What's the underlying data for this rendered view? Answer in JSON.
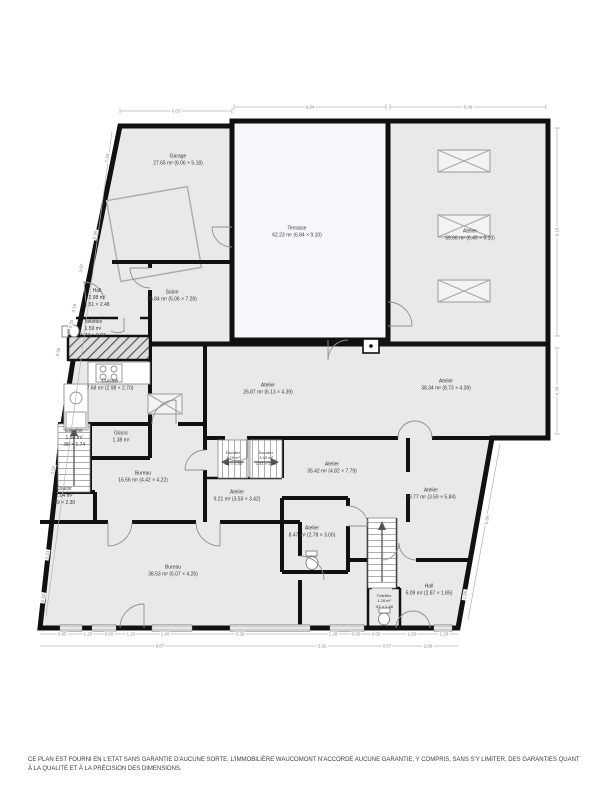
{
  "disclaimer": "CE PLAN EST FOURNI EN L'ETAT SANS GARANTIE D'AUCUNE SORTE. L'IMMOBILIÈRE WAUCOMONT N'ACCORDE AUCUNE GARANTIE, Y COMPRIS, SANS S'Y LIMITER, DES GARANTIES QUANT À LA QUALITÉ ET À LA PRÉCISION DES DIMENSIONS.",
  "rooms": {
    "garage": {
      "name": "Garage",
      "area": "27.65 m²",
      "dims": "(6.06 × 5.18)"
    },
    "terrasse": {
      "name": "Terrasse",
      "area": "62.23 m²",
      "dims": "(6.84 × 9.10)"
    },
    "atelier_ne": {
      "name": "Atelier",
      "area": "59.66 m²",
      "dims": "(6.49 × 9.10)"
    },
    "salon": {
      "name": "Salon",
      "area": "26.84 m²",
      "dims": "(5.06 × 7.28)"
    },
    "hall_nw": {
      "name": "Hall",
      "area": "2.98 m²",
      "dims": "1.51 × 2.48"
    },
    "toilettes_nw": {
      "name": "Toilettes",
      "area": "1.59 m²",
      "dims": "1.74 × 0.97"
    },
    "cuisine": {
      "name": "Cuisine",
      "area": "7.68 m²",
      "dims": "(2.98 × 2.70)"
    },
    "escalier_w": {
      "name": "Escalier",
      "area": "1.50 m²",
      "dims": ".86 × 1.74"
    },
    "glacis": {
      "name": "Glacis",
      "area": "1.38 m²",
      "dims": ""
    },
    "bureau_mid": {
      "name": "Bureau",
      "area": "16.56 m²",
      "dims": "(4.42 × 4.22)"
    },
    "couloir": {
      "name": "Couloir",
      "area": "2.04 m²",
      "dims": ".89 × 2.30"
    },
    "atelier_c": {
      "name": "Atelier",
      "area": "26.87 m²",
      "dims": "(6.13 × 4.39)"
    },
    "atelier_e": {
      "name": "Atelier",
      "area": "38.34 m²",
      "dims": "(8.73 × 4.39)"
    },
    "escalier_c1": {
      "name": "Escalier",
      "area": "1.29 m²",
      "dims": ".86 × 1.50"
    },
    "escalier_c2": {
      "name": "Escalier",
      "area": "3.43 m²",
      "dims": "1.41 × 2.43"
    },
    "atelier_s": {
      "name": "Atelier",
      "area": "35.42 m²",
      "dims": "(4.82 × 7.79)"
    },
    "atelier_sw": {
      "name": "Atelier",
      "area": "9.21 m²",
      "dims": "(3.53 × 3.42)"
    },
    "atelier_se": {
      "name": "Atelier",
      "area": "18.77 m²",
      "dims": "(3.59 × 5.84)"
    },
    "atelier_wc": {
      "name": "Atelier",
      "area": "8.47 m²",
      "dims": "(2.78 × 3.05)"
    },
    "bureau_s": {
      "name": "Bureau",
      "area": "38.53 m²",
      "dims": "(5.07 × 4.26)"
    },
    "hall_se": {
      "name": "Hall",
      "area": "5.09 m²",
      "dims": "(2.87 × 1.85)"
    },
    "toilettes_s": {
      "name": "Toilettes",
      "area": "1.28 m²",
      "dims": ".87 × 1.48"
    }
  },
  "dims": {
    "top": [
      "6.03",
      "6.84",
      "6.49"
    ],
    "left": [
      "1.04",
      "2.99",
      "3.67",
      "0.16",
      "0.55",
      "0.95",
      "2.50",
      "1.23",
      "0.90"
    ],
    "right": [
      "9.10",
      "4.39",
      "5.84",
      "1.85"
    ],
    "bottom1": [
      "0.95",
      "1.20",
      "0.60",
      "1.20",
      "1.40",
      "3.38",
      "1.28",
      "0.60",
      "0.60",
      "1.50",
      "1.26"
    ],
    "bottom2": [
      "9.07",
      "3.92",
      "0.67",
      "2.68"
    ]
  },
  "colors": {
    "wall": "#111111",
    "room_fill": "#e9e9e9",
    "terrace_fill": "#f5f7fa",
    "dim_line": "#aaaaaa"
  }
}
